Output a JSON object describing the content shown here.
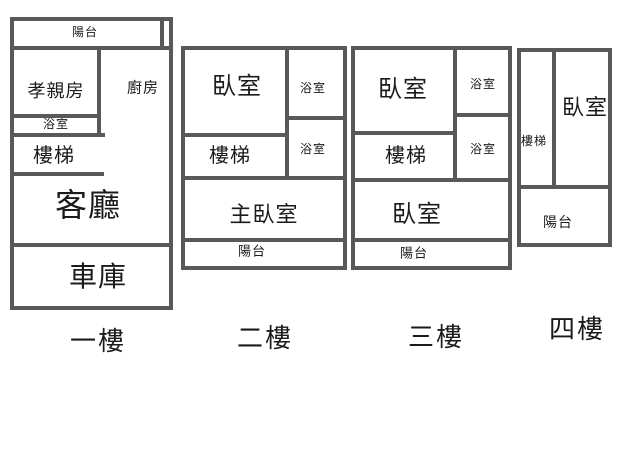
{
  "floorplan": {
    "type": "house-floor-plan-diagram",
    "colors": {
      "wall": "#59595b",
      "text": "#1b1b1b",
      "background": "#ffffff"
    },
    "floors": [
      {
        "name": "first-floor",
        "title": "一樓",
        "title_pos": {
          "x": 98,
          "y": 341,
          "size": 26
        },
        "walls": [
          {
            "x": 10,
            "y": 17,
            "w": 4,
            "h": 293
          },
          {
            "x": 10,
            "y": 17,
            "w": 163,
            "h": 4
          },
          {
            "x": 169,
            "y": 17,
            "w": 4,
            "h": 293
          },
          {
            "x": 10,
            "y": 306,
            "w": 163,
            "h": 4
          },
          {
            "x": 160,
            "y": 17,
            "w": 4,
            "h": 33
          },
          {
            "x": 10,
            "y": 46,
            "w": 163,
            "h": 4
          },
          {
            "x": 97,
            "y": 46,
            "w": 4,
            "h": 91
          },
          {
            "x": 10,
            "y": 114,
            "w": 91,
            "h": 4
          },
          {
            "x": 10,
            "y": 133,
            "w": 95,
            "h": 4
          },
          {
            "x": 10,
            "y": 172,
            "w": 94,
            "h": 4
          },
          {
            "x": 10,
            "y": 243,
            "w": 163,
            "h": 4
          }
        ],
        "rooms": [
          {
            "name": "balcony",
            "label": "陽台",
            "x": 85,
            "y": 32,
            "size": 12
          },
          {
            "name": "parents-room",
            "label": "孝親房",
            "x": 56,
            "y": 91,
            "size": 18
          },
          {
            "name": "kitchen",
            "label": "廚房",
            "x": 143,
            "y": 88,
            "size": 15
          },
          {
            "name": "bathroom",
            "label": "浴室",
            "x": 56,
            "y": 124,
            "size": 12
          },
          {
            "name": "stairs",
            "label": "樓梯",
            "x": 54,
            "y": 156,
            "size": 20
          },
          {
            "name": "living-room",
            "label": "客廳",
            "x": 88,
            "y": 205,
            "size": 32
          },
          {
            "name": "garage",
            "label": "車庫",
            "x": 98,
            "y": 277,
            "size": 28
          }
        ]
      },
      {
        "name": "second-floor",
        "title": "二樓",
        "title_pos": {
          "x": 265,
          "y": 338,
          "size": 26
        },
        "walls": [
          {
            "x": 181,
            "y": 46,
            "w": 4,
            "h": 224
          },
          {
            "x": 181,
            "y": 46,
            "w": 166,
            "h": 4
          },
          {
            "x": 343,
            "y": 46,
            "w": 4,
            "h": 224
          },
          {
            "x": 181,
            "y": 266,
            "w": 166,
            "h": 4
          },
          {
            "x": 285,
            "y": 46,
            "w": 4,
            "h": 134
          },
          {
            "x": 181,
            "y": 133,
            "w": 108,
            "h": 4
          },
          {
            "x": 289,
            "y": 116,
            "w": 58,
            "h": 4
          },
          {
            "x": 181,
            "y": 176,
            "w": 166,
            "h": 4
          },
          {
            "x": 181,
            "y": 238,
            "w": 166,
            "h": 4
          }
        ],
        "rooms": [
          {
            "name": "bedroom",
            "label": "臥室",
            "x": 237,
            "y": 87,
            "size": 24
          },
          {
            "name": "bathroom-upper",
            "label": "浴室",
            "x": 313,
            "y": 88,
            "size": 12
          },
          {
            "name": "stairs",
            "label": "樓梯",
            "x": 230,
            "y": 156,
            "size": 20
          },
          {
            "name": "bathroom-lower",
            "label": "浴室",
            "x": 313,
            "y": 149,
            "size": 12
          },
          {
            "name": "master-bedroom",
            "label": "主臥室",
            "x": 264,
            "y": 215,
            "size": 22
          },
          {
            "name": "balcony",
            "label": "陽台",
            "x": 252,
            "y": 251,
            "size": 13
          }
        ]
      },
      {
        "name": "third-floor",
        "title": "三樓",
        "title_pos": {
          "x": 436,
          "y": 337,
          "size": 26
        },
        "walls": [
          {
            "x": 351,
            "y": 46,
            "w": 4,
            "h": 224
          },
          {
            "x": 351,
            "y": 46,
            "w": 161,
            "h": 4
          },
          {
            "x": 508,
            "y": 46,
            "w": 4,
            "h": 224
          },
          {
            "x": 351,
            "y": 266,
            "w": 161,
            "h": 4
          },
          {
            "x": 453,
            "y": 46,
            "w": 4,
            "h": 134
          },
          {
            "x": 351,
            "y": 131,
            "w": 106,
            "h": 4
          },
          {
            "x": 453,
            "y": 113,
            "w": 59,
            "h": 4
          },
          {
            "x": 351,
            "y": 178,
            "w": 161,
            "h": 4
          },
          {
            "x": 351,
            "y": 238,
            "w": 161,
            "h": 4
          }
        ],
        "rooms": [
          {
            "name": "bedroom-upper",
            "label": "臥室",
            "x": 403,
            "y": 90,
            "size": 24
          },
          {
            "name": "bathroom-upper",
            "label": "浴室",
            "x": 483,
            "y": 84,
            "size": 12
          },
          {
            "name": "stairs",
            "label": "樓梯",
            "x": 406,
            "y": 156,
            "size": 20
          },
          {
            "name": "bathroom-lower",
            "label": "浴室",
            "x": 483,
            "y": 149,
            "size": 12
          },
          {
            "name": "bedroom-lower",
            "label": "臥室",
            "x": 417,
            "y": 215,
            "size": 24
          },
          {
            "name": "balcony",
            "label": "陽台",
            "x": 414,
            "y": 253,
            "size": 13
          }
        ]
      },
      {
        "name": "fourth-floor",
        "title": "四樓",
        "title_pos": {
          "x": 577,
          "y": 329,
          "size": 26
        },
        "walls": [
          {
            "x": 517,
            "y": 48,
            "w": 4,
            "h": 199
          },
          {
            "x": 517,
            "y": 48,
            "w": 95,
            "h": 4
          },
          {
            "x": 608,
            "y": 48,
            "w": 4,
            "h": 199
          },
          {
            "x": 517,
            "y": 243,
            "w": 95,
            "h": 4
          },
          {
            "x": 552,
            "y": 48,
            "w": 4,
            "h": 139
          },
          {
            "x": 517,
            "y": 185,
            "w": 95,
            "h": 4
          }
        ],
        "rooms": [
          {
            "name": "stairs",
            "label": "樓梯",
            "x": 534,
            "y": 141,
            "size": 12
          },
          {
            "name": "bedroom",
            "label": "臥室",
            "x": 585,
            "y": 108,
            "size": 22
          },
          {
            "name": "balcony",
            "label": "陽台",
            "x": 558,
            "y": 222,
            "size": 14
          }
        ]
      }
    ]
  }
}
